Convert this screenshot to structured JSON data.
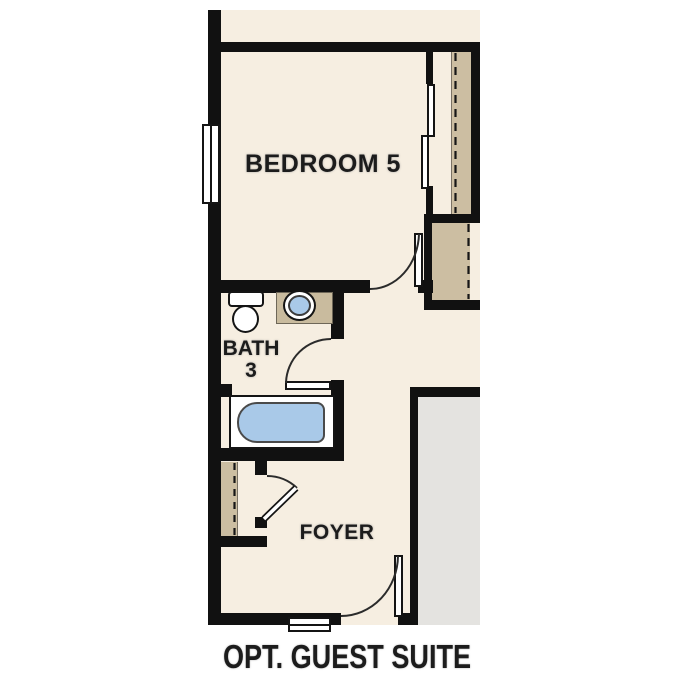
{
  "floorplan": {
    "caption": "OPT. GUEST SUITE",
    "rooms": [
      {
        "id": "bedroom-5",
        "label": "BEDROOM 5"
      },
      {
        "id": "bath-3",
        "label": "BATH",
        "label2": "3"
      },
      {
        "id": "foyer",
        "label": "FOYER"
      }
    ],
    "symbols": [
      "window",
      "sliding-closet-doors",
      "closet-dashed-shelf-line",
      "toilet",
      "sink-vanity",
      "bathtub",
      "hinged-door-swing-arc",
      "porch-steps",
      "exterior-adjacent-area"
    ],
    "colors": {
      "wall": "#111111",
      "floor": "#f6eee1",
      "closet": "#ccbea2",
      "counter": "#c9bb9e",
      "exterior": "#e4e3e0",
      "water": "#a9c9e8",
      "line": "#2b2b2b"
    }
  }
}
